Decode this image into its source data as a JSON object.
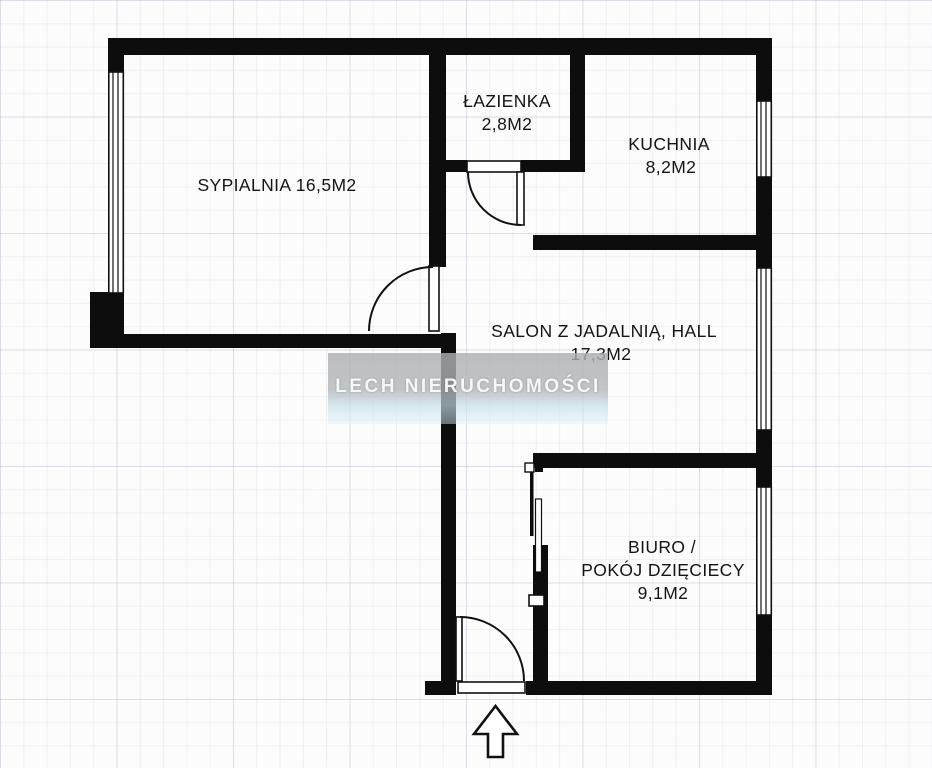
{
  "plan": {
    "type": "apartment-floor-plan",
    "watermark": {
      "text": "LECH NIERUCHOMOŚCI"
    },
    "rooms": {
      "sypialnia": {
        "label": "SYPIALNIA 16,5M2"
      },
      "lazienka": {
        "name": "ŁAZIENKA",
        "area": "2,8M2"
      },
      "kuchnia": {
        "name": "KUCHNIA",
        "area": "8,2M2"
      },
      "salon": {
        "name": "SALON Z JADALNIĄ, HALL",
        "area": "17,3M2"
      },
      "biuro": {
        "name_line1": "BIURO /",
        "name_line2": "POKÓJ DZIĘCIECY",
        "area": "9,1M2"
      }
    },
    "colors": {
      "wall": "#0d0d0d",
      "background": "#fcfcfd",
      "grid_line": "#e8e9ee",
      "watermark_gray": "#b2b4b6",
      "watermark_blue": "#ddf2f9",
      "watermark_text": "#fdfefe",
      "label_text": "#141414"
    },
    "symbols": {
      "entrance_arrow": "up-arrow",
      "door_symbol": "quarter-circle-swing",
      "window_symbol": "double-line",
      "sliding_door_symbol": "overlapping-panels"
    }
  }
}
